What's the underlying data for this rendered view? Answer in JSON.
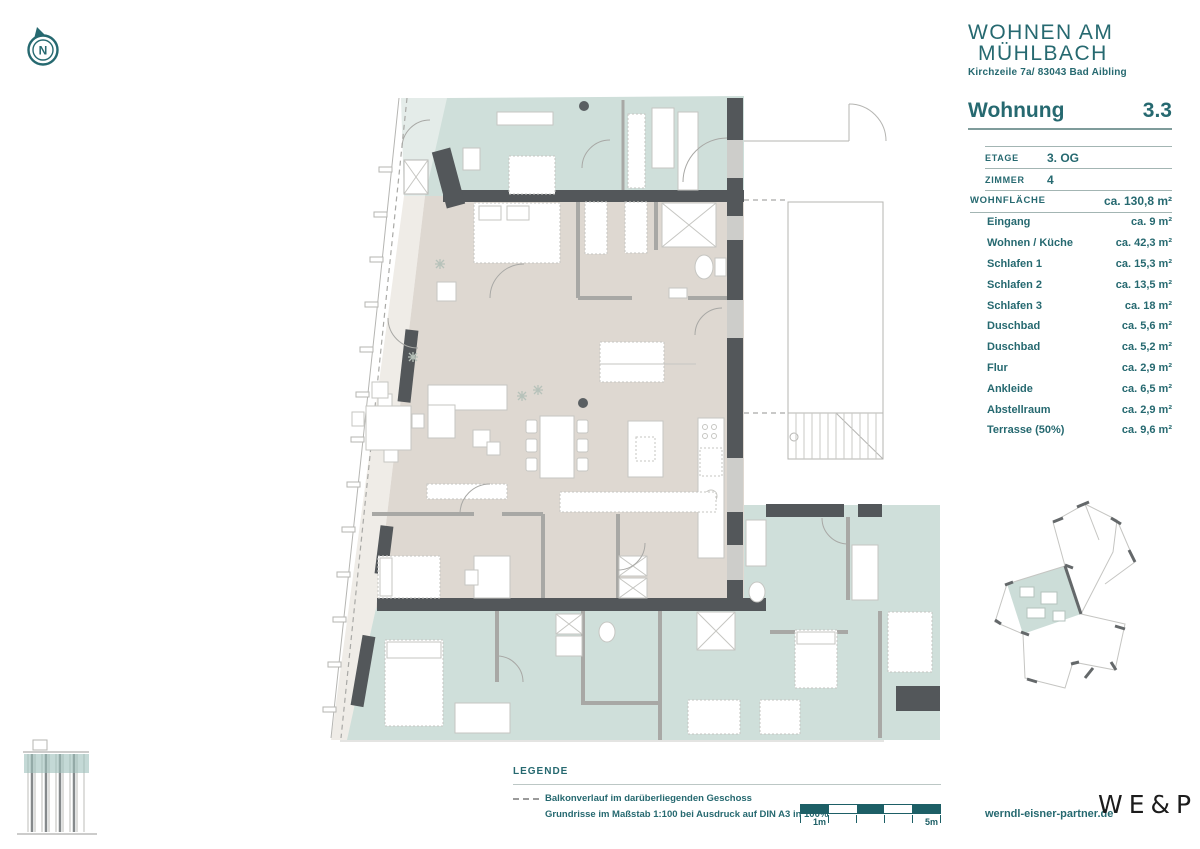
{
  "brand": {
    "name_line1": "WOHNEN AM",
    "name_line2": "MÜHLBACH",
    "address": "Kirchzeile 7a/ 83043 Bad Aibling"
  },
  "unit": {
    "title": "Wohnung",
    "number": "3.3"
  },
  "meta": [
    {
      "label": "ETAGE",
      "value": "3. OG"
    },
    {
      "label": "ZIMMER",
      "value": "4"
    }
  ],
  "area_total": {
    "label": "WOHNFLÄCHE",
    "value": "ca. 130,8 m²"
  },
  "rooms": [
    {
      "label": "Eingang",
      "value": "ca. 9 m²"
    },
    {
      "label": "Wohnen / Küche",
      "value": "ca. 42,3 m²"
    },
    {
      "label": "Schlafen 1",
      "value": "ca. 15,3 m²"
    },
    {
      "label": "Schlafen 2",
      "value": "ca. 13,5 m²"
    },
    {
      "label": "Schlafen 3",
      "value": "ca. 18 m²"
    },
    {
      "label": "Duschbad",
      "value": "ca. 5,6 m²"
    },
    {
      "label": "Duschbad",
      "value": "ca. 5,2 m²"
    },
    {
      "label": "Flur",
      "value": "ca. 2,9 m²"
    },
    {
      "label": "Ankleide",
      "value": "ca. 6,5 m²"
    },
    {
      "label": "Abstellraum",
      "value": "ca. 2,9 m²"
    },
    {
      "label": "Terrasse (50%)",
      "value": "ca. 9,6 m²"
    }
  ],
  "legend": {
    "title": "LEGENDE",
    "item_balcony": "Balkonverlauf im darüberliegenden Geschoss",
    "item_scale": "Grundrisse im Maßstab 1:100 bei Ausdruck auf DIN A3 in 100%"
  },
  "scalebar": {
    "label_1": "1m",
    "label_5": "5m"
  },
  "footer": {
    "website": "werndl-eisner-partner.de",
    "logo": "WE&P"
  },
  "compass": {
    "letter": "N"
  },
  "colors": {
    "accent_teal": "#266970",
    "scalebar_teal": "#1d5f66",
    "plan_unit_fill": "#ded8d1",
    "plan_neighbor_fill": "#cfdfda",
    "plan_terrace_fill": "#efece7",
    "wall_dark": "#53575a",
    "logo_black": "#1c1c1c"
  }
}
